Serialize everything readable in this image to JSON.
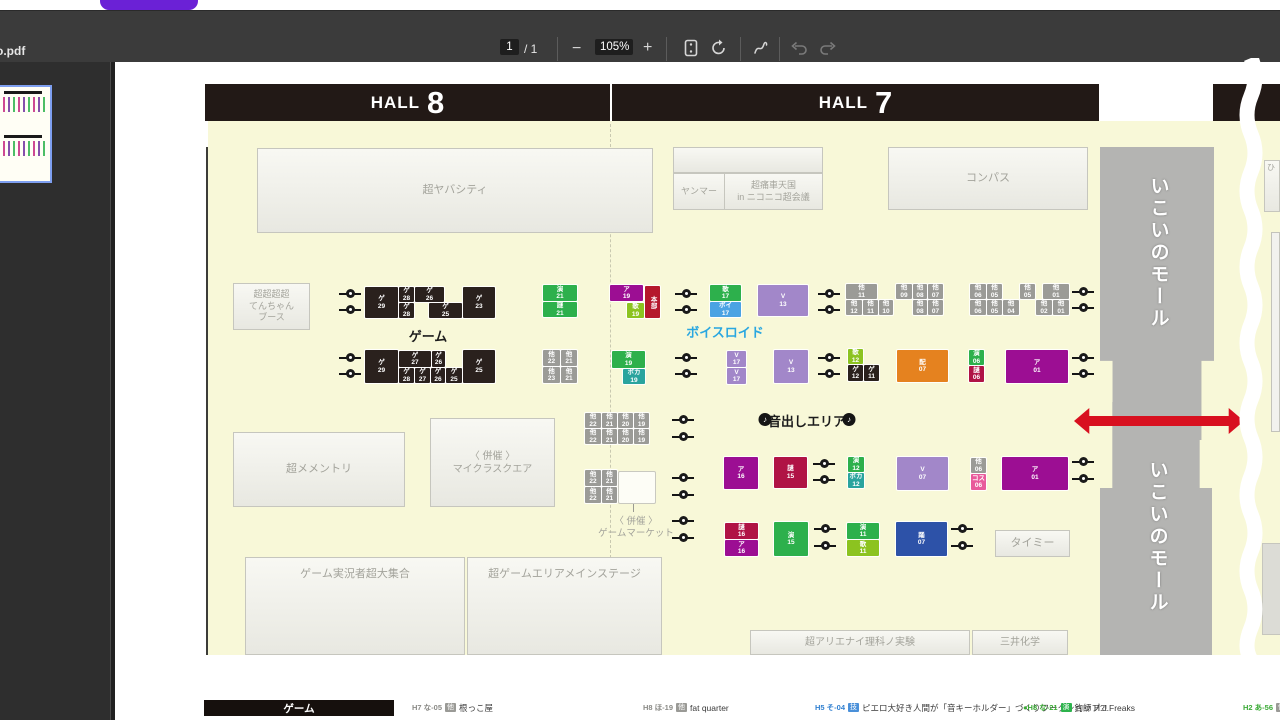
{
  "toolbar": {
    "filename": "o.pdf",
    "page": "1",
    "page_total": "/ 1",
    "zoom_out": "−",
    "zoom_level": "105%",
    "zoom_in": "+"
  },
  "colors": {
    "map_background": "#f8f8d8",
    "arrow_red": "#d8101f",
    "voiceroid_label_blue": "#2aa7e0",
    "hall_bar": "#221916",
    "corridor_gray": "#b4b4b2",
    "tab_pill_purple": "#6b21d6"
  },
  "map": {
    "halls": [
      {
        "x": 205,
        "w": 405,
        "word": "HALL",
        "num": "8"
      },
      {
        "x": 612,
        "w": 487,
        "word": "HALL",
        "num": "7"
      },
      {
        "x": 1213,
        "w": 67,
        "word": "",
        "num": ""
      }
    ],
    "areas": [
      [
        257,
        148,
        396,
        85,
        "超ヤバシティ",
        ""
      ],
      [
        673,
        147,
        150,
        26,
        "",
        ""
      ],
      [
        673,
        173,
        52,
        37,
        "ヤンマー",
        "s9"
      ],
      [
        724,
        173,
        99,
        37,
        "超痛車天国\nin ニコニコ超会議",
        "s9"
      ],
      [
        888,
        147,
        200,
        63,
        "コンパス",
        ""
      ],
      [
        233,
        283,
        77,
        47,
        "超超超超\nてんちゃん\nブース",
        "s9"
      ],
      [
        233,
        432,
        172,
        75,
        "超メメントリ",
        ""
      ],
      [
        430,
        418,
        125,
        89,
        "〈 併催 〉\nマイクラスクエア",
        "s10"
      ],
      [
        245,
        557,
        220,
        98,
        "ゲーム実況者超大集合",
        "top"
      ],
      [
        467,
        557,
        195,
        98,
        "超ゲームエリアメインステージ",
        "top"
      ],
      [
        750,
        630,
        220,
        25,
        "超アリエナイ理科ノ実験",
        "s10"
      ],
      [
        972,
        630,
        96,
        25,
        "三井化学",
        "s10"
      ],
      [
        995,
        530,
        75,
        27,
        "タイミー",
        ""
      ],
      [
        1264,
        160,
        16,
        52,
        "ひ",
        "s8"
      ]
    ],
    "booths": [
      [
        365,
        287,
        33,
        31,
        "black",
        "ゲ|29"
      ],
      [
        399,
        287,
        15,
        15,
        "black",
        "ゲ|28"
      ],
      [
        415,
        287,
        29,
        15,
        "black",
        "ゲ|26"
      ],
      [
        399,
        303,
        15,
        15,
        "black",
        "ゲ|28"
      ],
      [
        429,
        303,
        33,
        15,
        "black",
        "ゲ|25"
      ],
      [
        463,
        287,
        32,
        31,
        "black",
        "ゲ|23"
      ],
      [
        365,
        350,
        33,
        33,
        "black",
        "ゲ|29"
      ],
      [
        399,
        351,
        32,
        16,
        "black",
        "ゲ|27"
      ],
      [
        432,
        351,
        13,
        16,
        "black",
        "ゲ|26"
      ],
      [
        399,
        368,
        15,
        15,
        "black",
        "ゲ|28"
      ],
      [
        415,
        368,
        15,
        15,
        "black",
        "ゲ|27"
      ],
      [
        431,
        368,
        14,
        15,
        "black",
        "ゲ|26"
      ],
      [
        446,
        368,
        16,
        15,
        "black",
        "ゲ|25"
      ],
      [
        463,
        350,
        32,
        33,
        "black",
        "ゲ|25"
      ],
      [
        543,
        285,
        34,
        16,
        "green",
        "演|21"
      ],
      [
        543,
        302,
        34,
        15,
        "green",
        "謎|21"
      ],
      [
        610,
        285,
        33,
        16,
        "magenta",
        "ア|19"
      ],
      [
        627,
        303,
        17,
        15,
        "lime",
        "歌|19"
      ],
      [
        645,
        286,
        15,
        32,
        "red",
        "本部"
      ],
      [
        710,
        285,
        31,
        16,
        "green",
        "歌|17"
      ],
      [
        710,
        302,
        31,
        15,
        "blue",
        "ボイ|17"
      ],
      [
        758,
        285,
        50,
        31,
        "lpurple",
        "V|13"
      ],
      [
        846,
        284,
        31,
        15,
        "gray",
        "他|11"
      ],
      [
        896,
        284,
        16,
        15,
        "gray",
        "他|09"
      ],
      [
        913,
        284,
        14,
        15,
        "gray",
        "他|08"
      ],
      [
        928,
        284,
        15,
        15,
        "gray",
        "他|07"
      ],
      [
        846,
        300,
        16,
        15,
        "gray",
        "他|12"
      ],
      [
        863,
        300,
        15,
        15,
        "gray",
        "他|11"
      ],
      [
        879,
        300,
        14,
        15,
        "gray",
        "他|10"
      ],
      [
        913,
        300,
        14,
        15,
        "gray",
        "他|08"
      ],
      [
        928,
        300,
        15,
        15,
        "gray",
        "他|07"
      ],
      [
        970,
        284,
        16,
        15,
        "gray",
        "他|06"
      ],
      [
        987,
        284,
        15,
        15,
        "gray",
        "他|05"
      ],
      [
        1020,
        284,
        15,
        15,
        "gray",
        "他|05"
      ],
      [
        1043,
        284,
        26,
        15,
        "gray",
        "他|01"
      ],
      [
        970,
        300,
        16,
        15,
        "gray",
        "他|06"
      ],
      [
        987,
        300,
        15,
        15,
        "gray",
        "他|05"
      ],
      [
        1003,
        300,
        16,
        15,
        "gray",
        "他|04"
      ],
      [
        1036,
        300,
        16,
        15,
        "gray",
        "他|02"
      ],
      [
        1053,
        300,
        16,
        15,
        "gray",
        "他|01"
      ],
      [
        543,
        350,
        17,
        16,
        "gray",
        "他|22"
      ],
      [
        561,
        350,
        16,
        16,
        "gray",
        "他|21"
      ],
      [
        543,
        367,
        17,
        16,
        "gray",
        "他|23"
      ],
      [
        561,
        367,
        16,
        16,
        "gray",
        "他|21"
      ],
      [
        612,
        351,
        33,
        17,
        "green",
        "演|19"
      ],
      [
        623,
        369,
        22,
        15,
        "teal",
        "ボカ|19"
      ],
      [
        727,
        351,
        19,
        16,
        "lpurple",
        "V|17"
      ],
      [
        727,
        368,
        19,
        16,
        "lpurple",
        "V|17"
      ],
      [
        774,
        350,
        34,
        33,
        "lpurple",
        "V|13"
      ],
      [
        848,
        349,
        15,
        15,
        "lime",
        "歌|12"
      ],
      [
        848,
        365,
        15,
        16,
        "black",
        "ゲ|12"
      ],
      [
        864,
        365,
        15,
        16,
        "black",
        "ゲ|11"
      ],
      [
        897,
        350,
        51,
        32,
        "orange",
        "配|07"
      ],
      [
        969,
        350,
        15,
        15,
        "green",
        "演|06"
      ],
      [
        969,
        366,
        15,
        16,
        "crimson",
        "謎|06"
      ],
      [
        1006,
        350,
        62,
        33,
        "magenta",
        "ア|01"
      ],
      [
        585,
        413,
        16,
        15,
        "gray",
        "他|22"
      ],
      [
        602,
        413,
        15,
        15,
        "gray",
        "他|21"
      ],
      [
        618,
        413,
        15,
        15,
        "gray",
        "他|20"
      ],
      [
        634,
        413,
        15,
        15,
        "gray",
        "他|19"
      ],
      [
        585,
        429,
        16,
        15,
        "gray",
        "他|22"
      ],
      [
        602,
        429,
        15,
        15,
        "gray",
        "他|21"
      ],
      [
        618,
        429,
        15,
        15,
        "gray",
        "他|20"
      ],
      [
        634,
        429,
        15,
        15,
        "gray",
        "他|19"
      ],
      [
        585,
        470,
        16,
        16,
        "gray",
        "他|22"
      ],
      [
        602,
        470,
        15,
        16,
        "gray",
        "他|21"
      ],
      [
        585,
        487,
        16,
        16,
        "gray",
        "他|22"
      ],
      [
        602,
        487,
        15,
        16,
        "gray",
        "他|21"
      ],
      [
        619,
        472,
        36,
        31,
        "white",
        ""
      ],
      [
        724,
        457,
        34,
        32,
        "magenta",
        "ア|16"
      ],
      [
        774,
        457,
        33,
        31,
        "crimson",
        "謎|15"
      ],
      [
        848,
        457,
        16,
        15,
        "green",
        "演|12"
      ],
      [
        848,
        473,
        16,
        15,
        "teal",
        "ボカ|12"
      ],
      [
        897,
        457,
        51,
        33,
        "lpurple",
        "V|07"
      ],
      [
        971,
        458,
        15,
        15,
        "gray",
        "他|06"
      ],
      [
        971,
        474,
        15,
        16,
        "pink",
        "コス|06"
      ],
      [
        1002,
        457,
        66,
        33,
        "magenta",
        "ア|01"
      ],
      [
        725,
        523,
        33,
        16,
        "crimson",
        "謎|16"
      ],
      [
        725,
        540,
        33,
        16,
        "magenta",
        "ア|16"
      ],
      [
        774,
        522,
        34,
        34,
        "green",
        "演|15"
      ],
      [
        847,
        523,
        32,
        16,
        "green",
        "演|11"
      ],
      [
        847,
        540,
        32,
        16,
        "lime",
        "歌|11"
      ],
      [
        896,
        522,
        51,
        34,
        "dblue",
        "踊|07"
      ]
    ],
    "speakers": [
      [
        350,
        293
      ],
      [
        350,
        309
      ],
      [
        686,
        293
      ],
      [
        686,
        309
      ],
      [
        829,
        293
      ],
      [
        829,
        309
      ],
      [
        1083,
        291
      ],
      [
        1083,
        307
      ],
      [
        350,
        357
      ],
      [
        350,
        373
      ],
      [
        686,
        357
      ],
      [
        686,
        373
      ],
      [
        829,
        357
      ],
      [
        829,
        373
      ],
      [
        1083,
        357
      ],
      [
        1083,
        373
      ],
      [
        683,
        419
      ],
      [
        683,
        436
      ],
      [
        683,
        477
      ],
      [
        683,
        494
      ],
      [
        683,
        520
      ],
      [
        683,
        537
      ],
      [
        824,
        463
      ],
      [
        824,
        479
      ],
      [
        825,
        528
      ],
      [
        825,
        545
      ],
      [
        962,
        528
      ],
      [
        962,
        545
      ],
      [
        1083,
        461
      ],
      [
        1083,
        478
      ]
    ],
    "texts": [
      {
        "x": 428,
        "y": 326,
        "t": "ゲーム",
        "cls": "blk"
      },
      {
        "x": 725,
        "y": 322,
        "t": "ボイスロイド",
        "cls": "blu"
      },
      {
        "x": 765,
        "y": 413,
        "t": "♪",
        "cls": "note"
      },
      {
        "x": 807,
        "y": 411,
        "t": "音出しエリア",
        "cls": "blk"
      },
      {
        "x": 849,
        "y": 413,
        "t": "♪",
        "cls": "note"
      },
      {
        "x": 636,
        "y": 513,
        "t": "〈 併催 〉",
        "cls": "gsm"
      },
      {
        "x": 636,
        "y": 525,
        "t": "ゲームマーケット",
        "cls": "gsm"
      },
      {
        "x": 1158,
        "y": 176,
        "t": "いこいのモール",
        "cls": "mall"
      },
      {
        "x": 1157,
        "y": 460,
        "t": "いこいのモール",
        "cls": "mall"
      }
    ],
    "legend": {
      "title": "ゲーム",
      "entries": [
        {
          "x": 412,
          "code": "H7 な-05",
          "cc": "#8a8a86",
          "badge": "他",
          "bb": "#9a9a96",
          "name": "根っこ屋"
        },
        {
          "x": 643,
          "code": "H8 ほ-19",
          "cc": "#8a8a86",
          "badge": "他",
          "bb": "#9a9a96",
          "name": "fat quarter"
        },
        {
          "x": 815,
          "code": "H5 そ-04",
          "cc": "#2f7fd0",
          "badge": "技",
          "bb": "#4a90d9",
          "name": "ピエロ大好き人間が「音キーホルダー」づくりワークショップ?!"
        },
        {
          "x": 1023,
          "code": "●H8 な-21",
          "cc": "#3aaa35",
          "badge": "演",
          "bb": "#2db34d",
          "name": "釣師 H.J.Freaks"
        },
        {
          "x": 1243,
          "code": "H2 あ-56",
          "cc": "#3aaa35",
          "badge": "他",
          "bb": "#9a9a96",
          "name": ""
        }
      ]
    }
  }
}
